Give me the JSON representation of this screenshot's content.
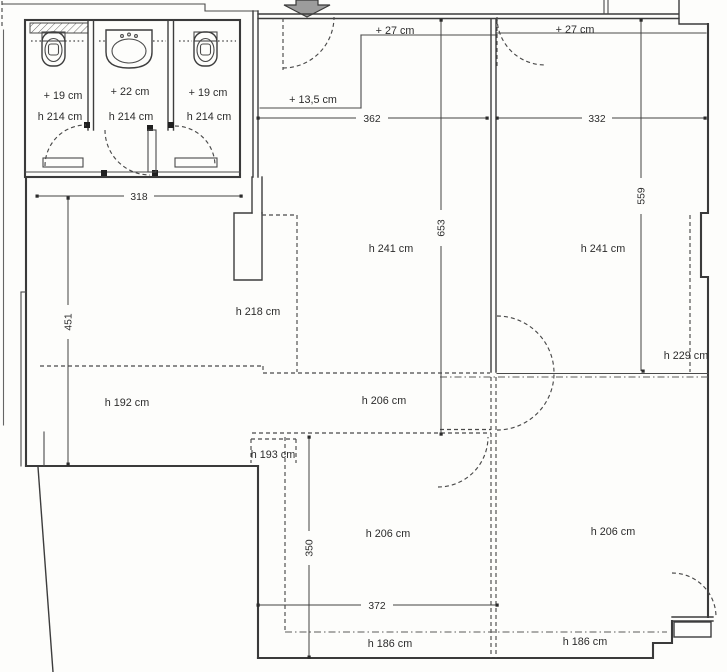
{
  "plan": {
    "bath": {
      "left_offset": "+ 19 cm",
      "mid_offset": "+ 22 cm",
      "right_offset": "+ 19 cm",
      "left_height": "h 214 cm",
      "mid_height": "h 214 cm",
      "right_height": "h 214 cm"
    },
    "steps": {
      "upper_left": "+ 27 cm",
      "upper_right": "+ 27 cm",
      "entry": "+ 13,5 cm"
    },
    "heights": {
      "room_upper_mid": "h 241 cm",
      "room_upper_right": "h 241 cm",
      "zone_left": "h 218 cm",
      "zone_lower_left": "h 192 cm",
      "zone_center": "h 206 cm",
      "zone_right_edge": "h 229 cm",
      "zone_niche": "h 193 cm",
      "room_lower_mid": "h 206 cm",
      "room_lower_right": "h 206 cm",
      "strip_bottom_left": "h 186 cm",
      "strip_bottom_right": "h 186 cm"
    },
    "dims": {
      "w_bath": "318",
      "w_upper_left": "362",
      "w_upper_right": "332",
      "h_left": "451",
      "h_center": "653",
      "h_right": "559",
      "h_lower": "350",
      "w_lower": "372"
    }
  }
}
